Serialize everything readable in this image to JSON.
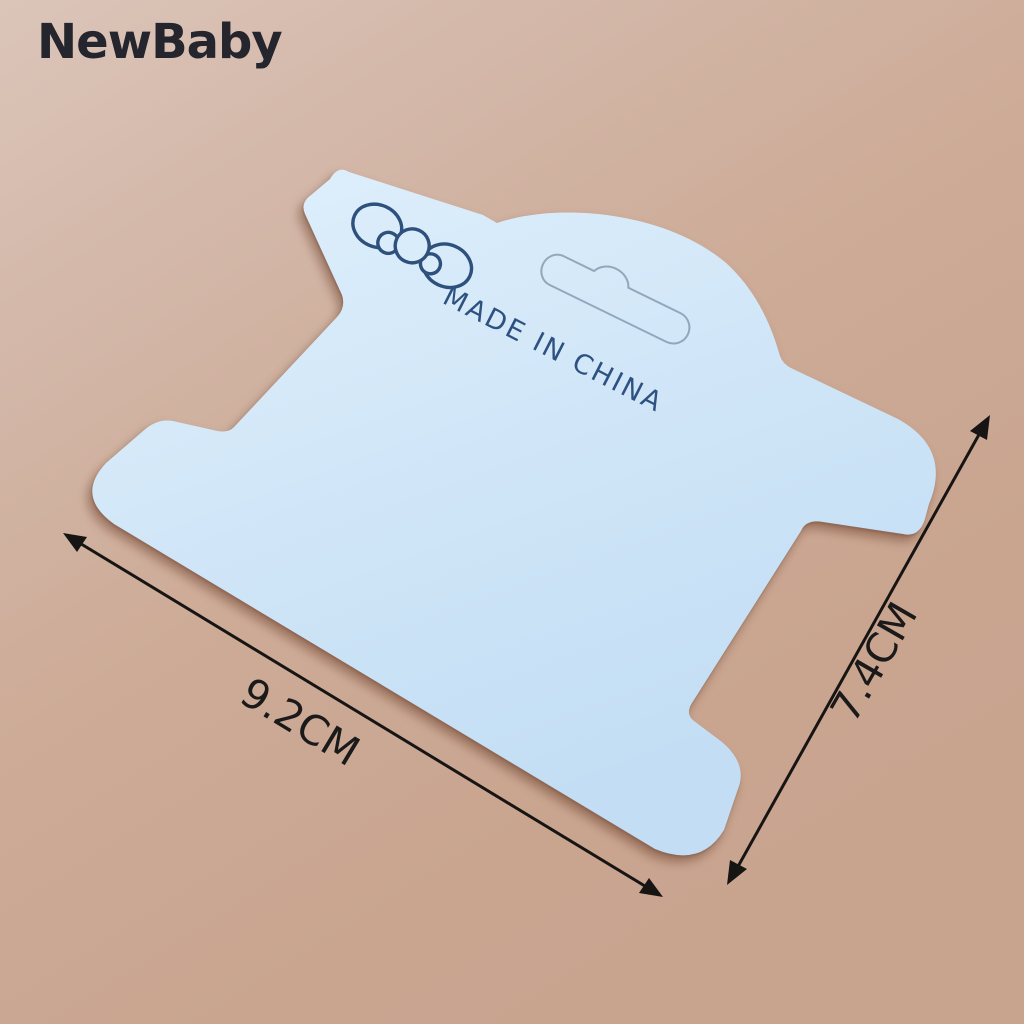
{
  "watermark": {
    "brand": "NewBaby",
    "color": "#24252d"
  },
  "background": {
    "top_left_color": "#dbc5b9",
    "bottom_right_color": "#c8a38e"
  },
  "product_card": {
    "kind": "blank spool-shaped display packing card, tilted on backdrop",
    "card_color": "#cfe4f7",
    "print_ink_color": "#2d5180",
    "print_text": "MADE IN CHINA",
    "icons": [
      "bow-icon",
      "euro-slot-cutout"
    ]
  },
  "dimensions": {
    "width_label": "9.2CM",
    "height_label": "7.4CM",
    "arrow_color": "#171513"
  }
}
